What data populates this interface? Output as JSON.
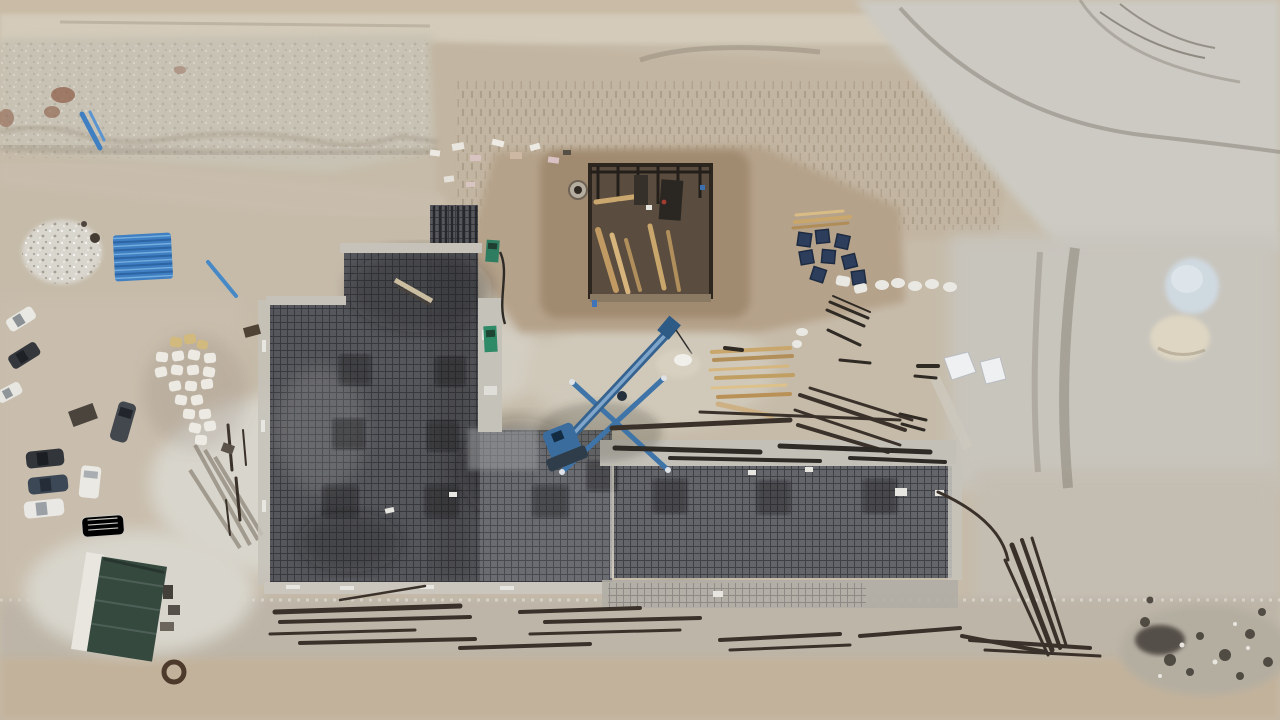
{
  "meta": {
    "title": "Aerial drone photograph of a building construction site",
    "view": "top-down"
  },
  "scene": {
    "description": "Top-down aerial photo of an excavated construction site: large dark rebar foundation mats at center, a timber formwork pit at top center, a blue pile-drilling rig, parked cars and vans on the left, stockpiles of rebar, lumber, pipes and sacks scattered over graded sandy ground.",
    "labels": {
      "terrain": "Graded sandy terrain with tire tracks",
      "bank": "Excavated bank and slope along the top",
      "mat_left": "Large L-shaped rebar foundation mat",
      "mat_right": "Rectangular rebar foundation mat",
      "pit": "Excavated pit with timber formwork and shoring",
      "manhole": "Concrete manhole ring",
      "rig": "Blue pile drilling rig with boom and outriggers",
      "pipes": "Stack of blue pipes",
      "gravel": "Pale gravel pile",
      "sacks_left": "Cluster of white and tan material sacks",
      "sacks_small": "White sacks near pit",
      "crates": "Dark blue crates",
      "lumber_pit": "Timber planks beside pit",
      "lumber_center": "Stacked lumber near rig",
      "rebar_bundles": "Bundles of dark steel rebar",
      "steel_beams": "Dark steel beams on concrete strip",
      "vehicles": "Parked cars and vans",
      "canopy": "Green canopy shelter with white edge",
      "hose_coil": "Coiled dark hose",
      "mounds": "Pale white and cream material mounds",
      "rubble": "Dark rubble patch at lower right",
      "green_equipment": "Small green machines on concrete strip",
      "tarps": "White tarps on ground",
      "sand_pile": "Small sand pile with white tarp",
      "blocks_row": "Row of scattered white and pink blocks",
      "tracks": "Tire and excavator track marks",
      "concrete_strips": "Light concrete edge strips and formwork"
    }
  },
  "colors": {
    "ground": "#c6bba9",
    "ground_light": "#d4cbba",
    "slope": "#c2b5a1",
    "gray_area": "#cccac3",
    "road": "#bdb5a7",
    "bottom_dirt": "#c2b29b",
    "concrete": "#c5c2ba",
    "patch_light": "#d8d5cc",
    "mat_dark": "#56575c",
    "mat_mid": "#6e6f74",
    "mat_right": "#64656a",
    "pit_soil": "#a08a70",
    "pit_dark": "#5a4c3e",
    "wood": "#c2a36e",
    "rig_blue": "#3e74a8",
    "pipe_blue": "#3f7fc2",
    "crate_navy": "#2c3e5c",
    "canopy_green": "#35493f",
    "white": "#eceae4",
    "car_dark": "#34373c",
    "rebar": "#3a322a",
    "rust": "#8a5a44"
  }
}
